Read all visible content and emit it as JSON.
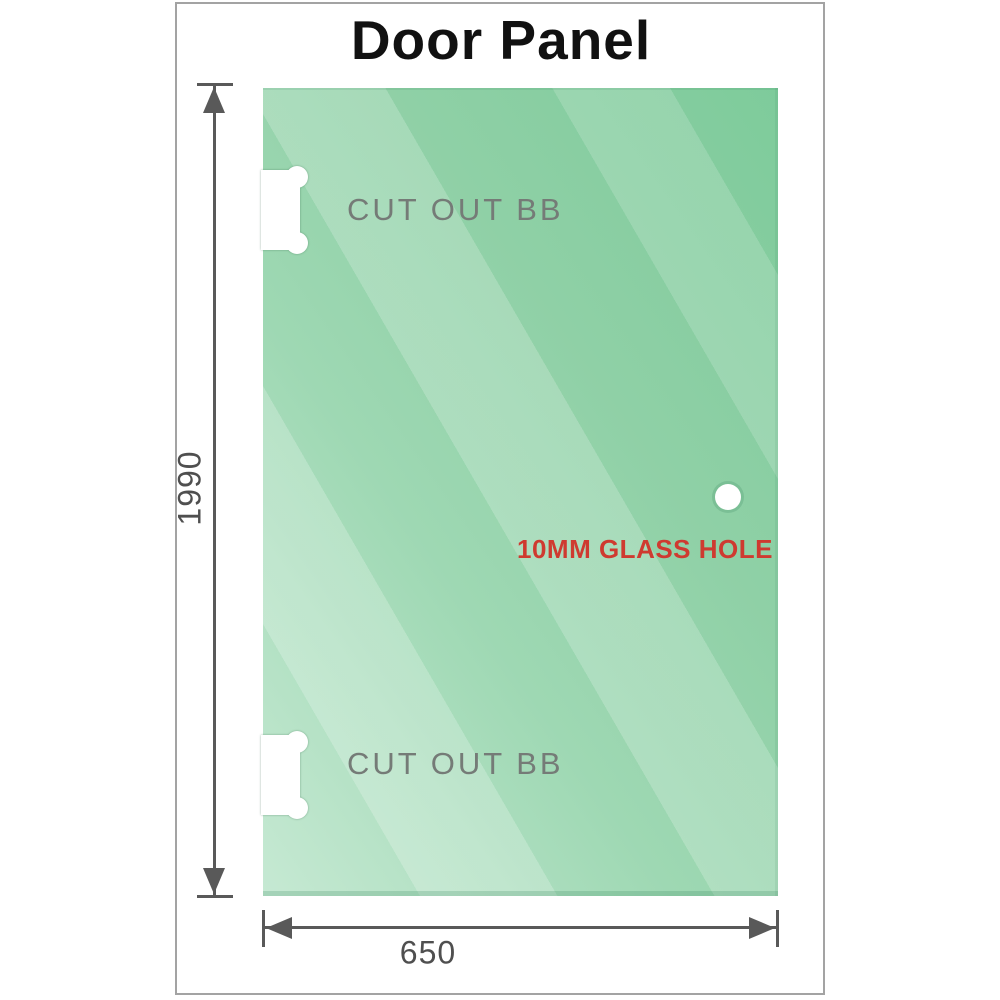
{
  "title": "Door Panel",
  "panel": {
    "cutouts": [
      {
        "label": "CUT OUT BB"
      },
      {
        "label": "CUT OUT BB"
      }
    ],
    "hole": {
      "label": "10MM GLASS HOLE"
    }
  },
  "dimensions": {
    "height": {
      "value": "1990"
    },
    "width": {
      "value": "650"
    }
  },
  "colors": {
    "glass_dark": "#7ecb9b",
    "glass_mid": "#93d1ab",
    "glass_light": "#c6e9d3",
    "hole_label": "#cf3a30",
    "cutout_label": "#757b77",
    "dimension": "#595959",
    "title": "#111111",
    "frame_border": "#a3a3a3"
  }
}
